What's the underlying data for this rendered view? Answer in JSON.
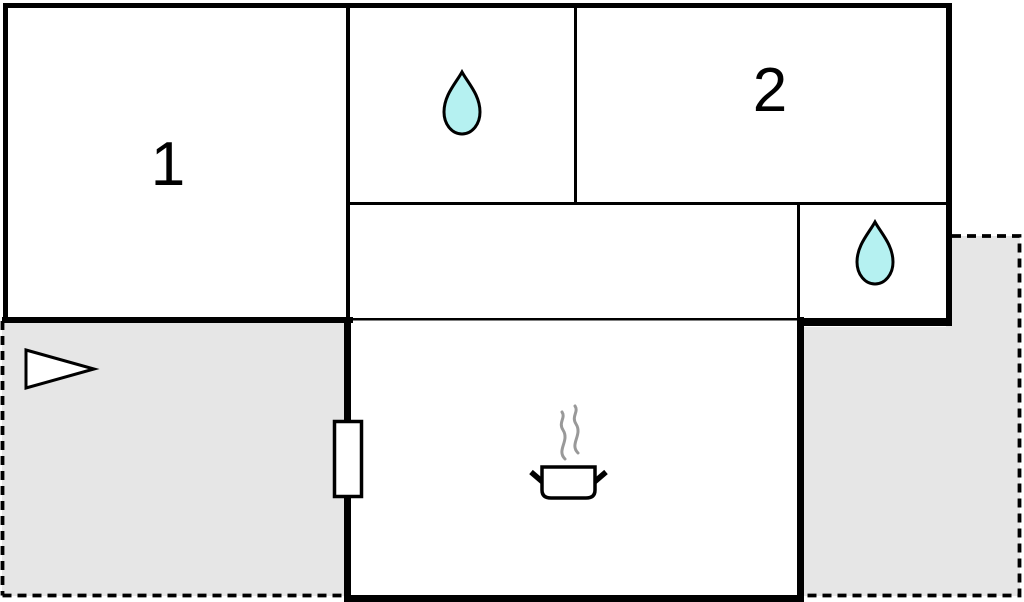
{
  "rooms": {
    "room1": {
      "label": "1"
    },
    "room2": {
      "label": "2"
    }
  },
  "icons": {
    "water_drop_top": "water-drop-icon",
    "water_drop_right": "water-drop-icon",
    "cooking_pot": "cooking-pot-icon",
    "entrance_arrow": "entrance-arrow-icon",
    "door": "door-icon"
  },
  "colors": {
    "wall": "#000000",
    "terrace_fill": "#e6e6e6",
    "room_fill": "#ffffff",
    "water_drop_fill": "#b5f1f1",
    "steam_stroke": "#999999"
  }
}
